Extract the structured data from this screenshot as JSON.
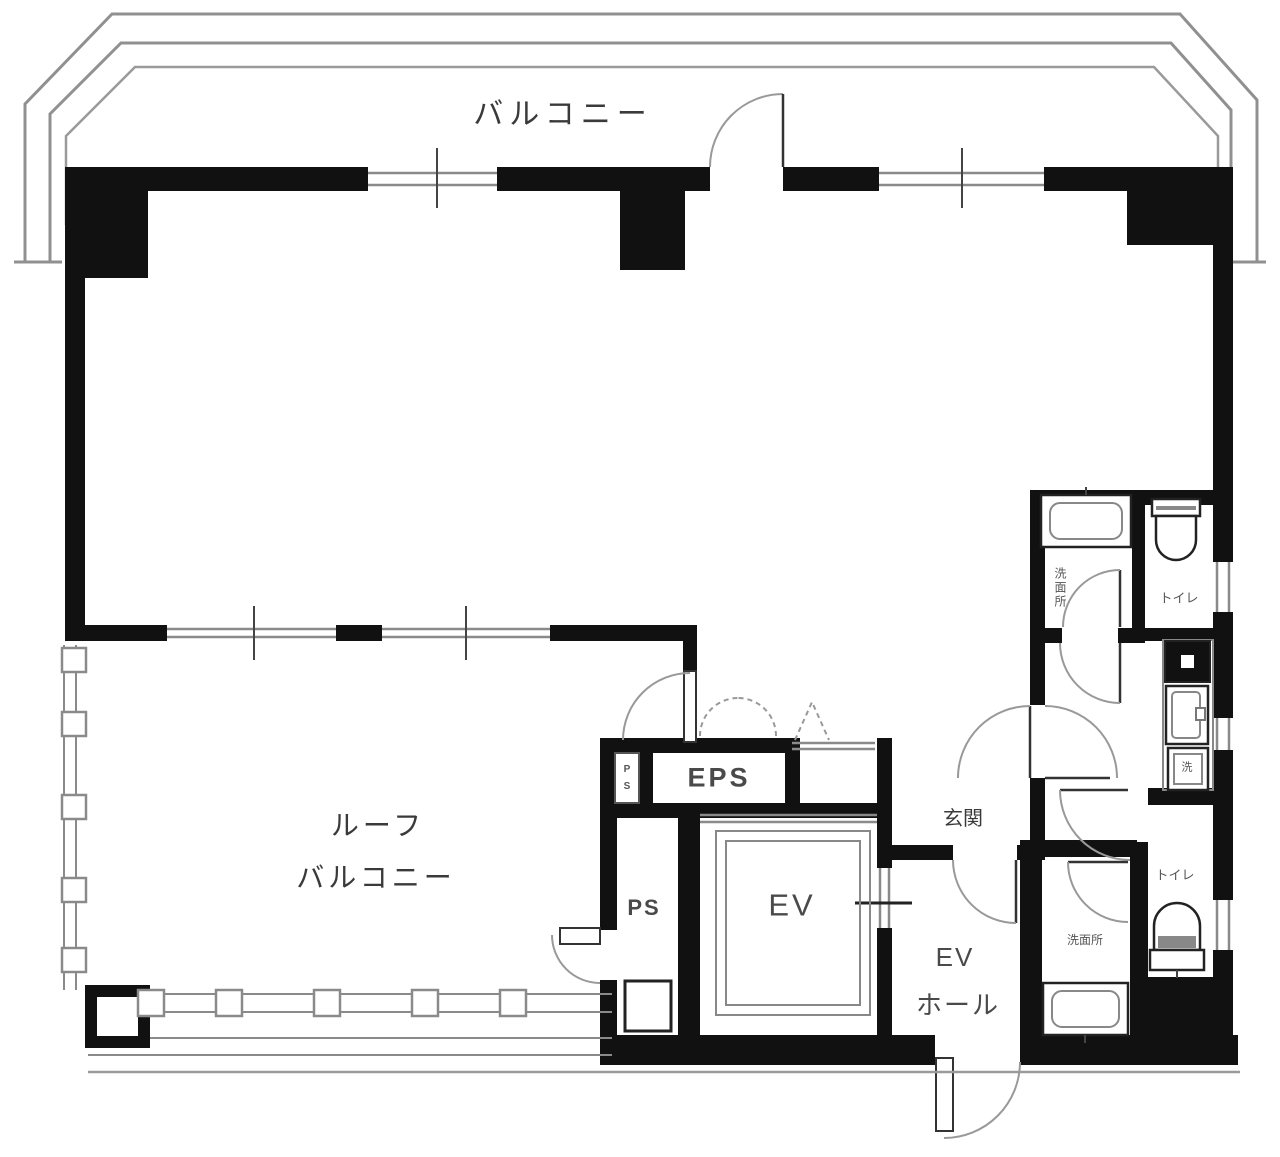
{
  "labels": {
    "balcony": "バルコニー",
    "roof_balcony_line1": "ルーフ",
    "roof_balcony_line2": "バルコニー",
    "eps": "EPS",
    "ps_shaft_p": "P",
    "ps_shaft_s": "S",
    "ps": "PS",
    "ev": "EV",
    "ev_hall_line1": "EV",
    "ev_hall_line2": "ホール",
    "entrance": "玄関",
    "washroom_top": "洗面所",
    "toilet_top": "トイレ",
    "toilet_bottom": "トイレ",
    "washroom_bottom": "洗面所",
    "laundry": "洗"
  },
  "colors": {
    "wall": "#111111",
    "line": "#8a8a8a",
    "parapet": "#909090",
    "label": "#3a3a3a",
    "bg": "#ffffff"
  }
}
